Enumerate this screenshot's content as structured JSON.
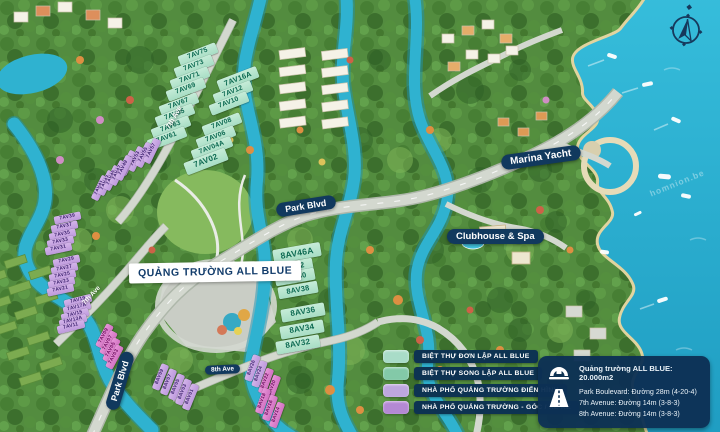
{
  "labels": {
    "plaza": "QUẢNG TRƯỜNG ALL BLUE",
    "marina": "Marina Yacht",
    "clubhouse": "Clubhouse & Spa",
    "park_blvd_center": "Park Blvd",
    "park_blvd_bottom": "Park Blvd",
    "ave7_top": "7th Ave",
    "ave7_mid": "7th Ave",
    "ave8": "8th Ave"
  },
  "watermark": "homnion.be",
  "plots": [
    {
      "id": "7AV75",
      "x": 198,
      "y": 54,
      "r": -21,
      "w": 40,
      "h": 11,
      "t": "green"
    },
    {
      "id": "7AV73",
      "x": 194,
      "y": 66,
      "r": -21,
      "w": 40,
      "h": 11,
      "t": "green"
    },
    {
      "id": "7AV71",
      "x": 190,
      "y": 78,
      "r": -21,
      "w": 40,
      "h": 11,
      "t": "green"
    },
    {
      "id": "7AV69",
      "x": 186,
      "y": 89,
      "r": -21,
      "w": 40,
      "h": 11,
      "t": "green"
    },
    {
      "id": "7AV67",
      "x": 179,
      "y": 104,
      "r": -21,
      "w": 40,
      "h": 11,
      "t": "green"
    },
    {
      "id": "7AV65",
      "x": 175,
      "y": 115,
      "r": -21,
      "w": 40,
      "h": 11,
      "t": "green"
    },
    {
      "id": "7AV63",
      "x": 171,
      "y": 127,
      "r": -21,
      "w": 40,
      "h": 11,
      "t": "green"
    },
    {
      "id": "7AV61",
      "x": 167,
      "y": 138,
      "r": -21,
      "w": 40,
      "h": 11,
      "t": "green"
    },
    {
      "id": "7AV16A",
      "x": 238,
      "y": 79,
      "r": -21,
      "w": 42,
      "h": 12,
      "t": "green"
    },
    {
      "id": "7AV12",
      "x": 233,
      "y": 92,
      "r": -21,
      "w": 40,
      "h": 11,
      "t": "green"
    },
    {
      "id": "7AV10",
      "x": 229,
      "y": 103,
      "r": -21,
      "w": 40,
      "h": 11,
      "t": "green"
    },
    {
      "id": "7AV08",
      "x": 222,
      "y": 124,
      "r": -21,
      "w": 40,
      "h": 11,
      "t": "green"
    },
    {
      "id": "7AV06",
      "x": 216,
      "y": 137,
      "r": -21,
      "w": 40,
      "h": 11,
      "t": "green"
    },
    {
      "id": "7AV04A",
      "x": 212,
      "y": 148,
      "r": -21,
      "w": 42,
      "h": 11,
      "t": "green"
    },
    {
      "id": "7AV02",
      "x": 206,
      "y": 161,
      "r": -21,
      "w": 44,
      "h": 13,
      "t": "green"
    },
    {
      "id": "7AV51",
      "x": 128,
      "y": 163,
      "r": -64,
      "w": 26,
      "h": 8,
      "t": "purple"
    },
    {
      "id": "7AV53",
      "x": 136,
      "y": 159,
      "r": -64,
      "w": 26,
      "h": 8,
      "t": "purple"
    },
    {
      "id": "7AV55",
      "x": 144,
      "y": 155,
      "r": -64,
      "w": 26,
      "h": 8,
      "t": "purple"
    },
    {
      "id": "7AV57",
      "x": 152,
      "y": 151,
      "r": -64,
      "w": 26,
      "h": 8,
      "t": "purple"
    },
    {
      "id": "7AV41",
      "x": 100,
      "y": 188,
      "r": -64,
      "w": 26,
      "h": 8,
      "t": "purple"
    },
    {
      "id": "7AV43",
      "x": 106,
      "y": 183,
      "r": -64,
      "w": 26,
      "h": 8,
      "t": "purple"
    },
    {
      "id": "7AV45",
      "x": 112,
      "y": 178,
      "r": -64,
      "w": 26,
      "h": 8,
      "t": "purple"
    },
    {
      "id": "7AV47",
      "x": 118,
      "y": 173,
      "r": -64,
      "w": 26,
      "h": 8,
      "t": "purple"
    },
    {
      "id": "7AV49",
      "x": 124,
      "y": 168,
      "r": -64,
      "w": 26,
      "h": 8,
      "t": "purple"
    },
    {
      "id": "7AV39",
      "x": 67,
      "y": 218,
      "r": -12,
      "w": 27,
      "h": 8,
      "t": "purple"
    },
    {
      "id": "7AV37",
      "x": 64,
      "y": 227,
      "r": -12,
      "w": 27,
      "h": 8,
      "t": "purple"
    },
    {
      "id": "7AV35",
      "x": 62,
      "y": 235,
      "r": -12,
      "w": 27,
      "h": 8,
      "t": "purple"
    },
    {
      "id": "7AV33",
      "x": 60,
      "y": 242,
      "r": -12,
      "w": 27,
      "h": 8,
      "t": "purple"
    },
    {
      "id": "7AV31",
      "x": 58,
      "y": 249,
      "r": -12,
      "w": 27,
      "h": 8,
      "t": "purple"
    },
    {
      "id": "7AV29",
      "x": 66,
      "y": 261,
      "r": -12,
      "w": 27,
      "h": 8,
      "t": "purple"
    },
    {
      "id": "7AV27",
      "x": 64,
      "y": 269,
      "r": -12,
      "w": 27,
      "h": 8,
      "t": "purple"
    },
    {
      "id": "7AV25",
      "x": 62,
      "y": 276,
      "r": -12,
      "w": 27,
      "h": 8,
      "t": "purple"
    },
    {
      "id": "7AV23",
      "x": 61,
      "y": 283,
      "r": -12,
      "w": 27,
      "h": 8,
      "t": "purple"
    },
    {
      "id": "7AV21",
      "x": 60,
      "y": 290,
      "r": -12,
      "w": 27,
      "h": 8,
      "t": "purple"
    },
    {
      "id": "7AV19",
      "x": 78,
      "y": 301,
      "r": -14,
      "w": 28,
      "h": 8,
      "t": "purple"
    },
    {
      "id": "7AV17A",
      "x": 77,
      "y": 308,
      "r": -14,
      "w": 28,
      "h": 8,
      "t": "purple"
    },
    {
      "id": "7AV15",
      "x": 75,
      "y": 315,
      "r": -14,
      "w": 28,
      "h": 8,
      "t": "purple"
    },
    {
      "id": "7AV13A",
      "x": 73,
      "y": 321,
      "r": -14,
      "w": 28,
      "h": 8,
      "t": "purple"
    },
    {
      "id": "7AV11",
      "x": 71,
      "y": 327,
      "r": -14,
      "w": 28,
      "h": 8,
      "t": "purple"
    },
    {
      "id": "7AV09",
      "x": 104,
      "y": 336,
      "r": -62,
      "w": 25,
      "h": 8,
      "t": "pink"
    },
    {
      "id": "7AV07",
      "x": 108,
      "y": 343,
      "r": -62,
      "w": 25,
      "h": 8,
      "t": "pink"
    },
    {
      "id": "7AV05",
      "x": 111,
      "y": 350,
      "r": -62,
      "w": 25,
      "h": 8,
      "t": "pink"
    },
    {
      "id": "7AV03",
      "x": 114,
      "y": 357,
      "r": -62,
      "w": 25,
      "h": 8,
      "t": "pink"
    },
    {
      "id": "8AV09",
      "x": 160,
      "y": 377,
      "r": -68,
      "w": 27,
      "h": 8,
      "t": "purple"
    },
    {
      "id": "8AV07",
      "x": 168,
      "y": 382,
      "r": -68,
      "w": 27,
      "h": 8,
      "t": "purple"
    },
    {
      "id": "8AV05",
      "x": 176,
      "y": 387,
      "r": -68,
      "w": 27,
      "h": 8,
      "t": "purple"
    },
    {
      "id": "8AV03",
      "x": 183,
      "y": 392,
      "r": -68,
      "w": 27,
      "h": 8,
      "t": "purple"
    },
    {
      "id": "8AV01",
      "x": 190,
      "y": 397,
      "r": -68,
      "w": 27,
      "h": 8,
      "t": "purple"
    },
    {
      "id": "8AV26",
      "x": 252,
      "y": 368,
      "r": -70,
      "w": 27,
      "h": 8,
      "t": "purple"
    },
    {
      "id": "8AV24",
      "x": 259,
      "y": 374,
      "r": -70,
      "w": 27,
      "h": 8,
      "t": "purple"
    },
    {
      "id": "8AV22",
      "x": 266,
      "y": 381,
      "r": -70,
      "w": 26,
      "h": 8,
      "t": "pink"
    },
    {
      "id": "8AV20",
      "x": 273,
      "y": 388,
      "r": -70,
      "w": 26,
      "h": 8,
      "t": "pink"
    },
    {
      "id": "8AV18",
      "x": 263,
      "y": 401,
      "r": -70,
      "w": 26,
      "h": 8,
      "t": "pink"
    },
    {
      "id": "8AV16",
      "x": 270,
      "y": 408,
      "r": -70,
      "w": 26,
      "h": 8,
      "t": "pink"
    },
    {
      "id": "8AV14",
      "x": 277,
      "y": 415,
      "r": -70,
      "w": 26,
      "h": 8,
      "t": "pink"
    },
    {
      "id": "8AV46A",
      "x": 297,
      "y": 253,
      "r": -10,
      "w": 48,
      "h": 14,
      "t": "green"
    },
    {
      "id": "8AV42",
      "x": 293,
      "y": 267,
      "r": -10,
      "w": 40,
      "h": 12,
      "t": "green"
    },
    {
      "id": "8AV40",
      "x": 295,
      "y": 277,
      "r": -10,
      "w": 40,
      "h": 12,
      "t": "green"
    },
    {
      "id": "8AV38",
      "x": 298,
      "y": 290,
      "r": -10,
      "w": 40,
      "h": 12,
      "t": "green"
    },
    {
      "id": "8AV36",
      "x": 303,
      "y": 312,
      "r": -10,
      "w": 44,
      "h": 13,
      "t": "green"
    },
    {
      "id": "8AV34",
      "x": 302,
      "y": 329,
      "r": -10,
      "w": 44,
      "h": 13,
      "t": "green"
    },
    {
      "id": "8AV32",
      "x": 298,
      "y": 344,
      "r": -10,
      "w": 44,
      "h": 13,
      "t": "green"
    }
  ],
  "legend": {
    "items": [
      {
        "color": "#a9dcc8",
        "label": "BIỆT THỰ ĐƠN LẬP ALL BLUE"
      },
      {
        "color": "#83c9a8",
        "label": "BIỆT THỰ SONG LẬP ALL BLUE"
      },
      {
        "color": "#bda7de",
        "label": "NHÀ PHỐ QUẢNG TRƯỜNG ĐIỂN HÌNH"
      },
      {
        "color": "#b489d4",
        "label": "NHÀ PHỐ QUẢNG TRƯỜNG - GÓC / XẾ KE"
      }
    ]
  },
  "info_box": {
    "plaza_line": "Quảng trường ALL BLUE: 20.000m2",
    "road_lines": [
      "Park Boulevard: Đường 28m (4-20-4)",
      "7th Avenue: Đường 14m (3-8-3)",
      "8th Avenue: Đường 14m (3-8-3)"
    ]
  }
}
